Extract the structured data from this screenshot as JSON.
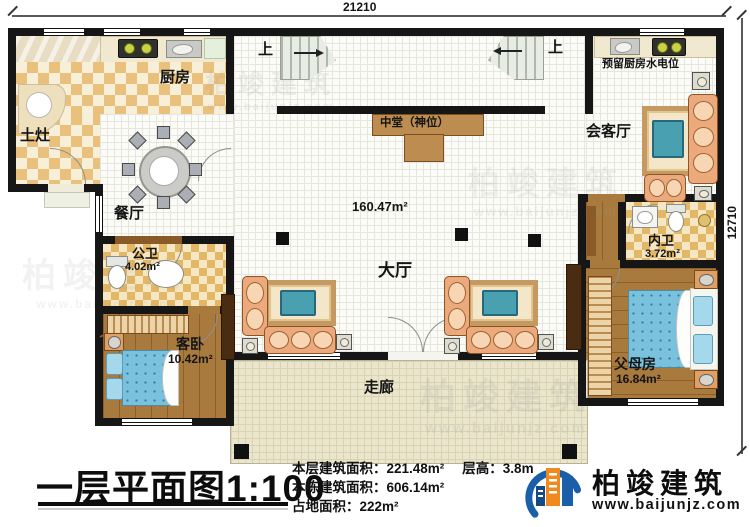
{
  "plan": {
    "scale_title": "一层平面图1:100",
    "dimensions": {
      "width": "21210",
      "height": "12710"
    },
    "rooms": {
      "kitchen": "厨房",
      "earth_stove": "土灶",
      "dining": "餐厅",
      "public_bath": "公卫",
      "public_bath_area": "4.02m²",
      "guest_bedroom": "客卧",
      "guest_bedroom_area": "10.42m²",
      "hall": "大厅",
      "hall_area": "160.47m²",
      "shrine_hall": "中堂（神位）",
      "reception": "会客厅",
      "reserved_kitchen_util": "预留厨房水电位",
      "inner_bath": "内卫",
      "inner_bath_area": "3.72m²",
      "parents_room": "父母房",
      "parents_room_area": "16.84m²",
      "corridor": "走廊",
      "stairs_up": "上"
    }
  },
  "info": {
    "floor_area_label": "本层建筑面积：",
    "floor_area": "221.48m²",
    "height_label": "层高：",
    "height": "3.8m",
    "total_area_label": "本栋建筑面积：",
    "total_area": "606.14m²",
    "land_area_label": "占地面积：",
    "land_area": "222m²"
  },
  "brand": {
    "name": "柏竣建筑",
    "website": "www.baijunjz.com"
  },
  "watermark": {
    "name": "柏竣建筑",
    "website": "www.baijunjz.com"
  },
  "colors": {
    "wall": "#161616",
    "checker": "#e9c07c",
    "wood": "#a87a3e",
    "accent_blue": "#1a5fa8",
    "accent_orange": "#f08a1e",
    "teal_table": "#48a0b0"
  }
}
